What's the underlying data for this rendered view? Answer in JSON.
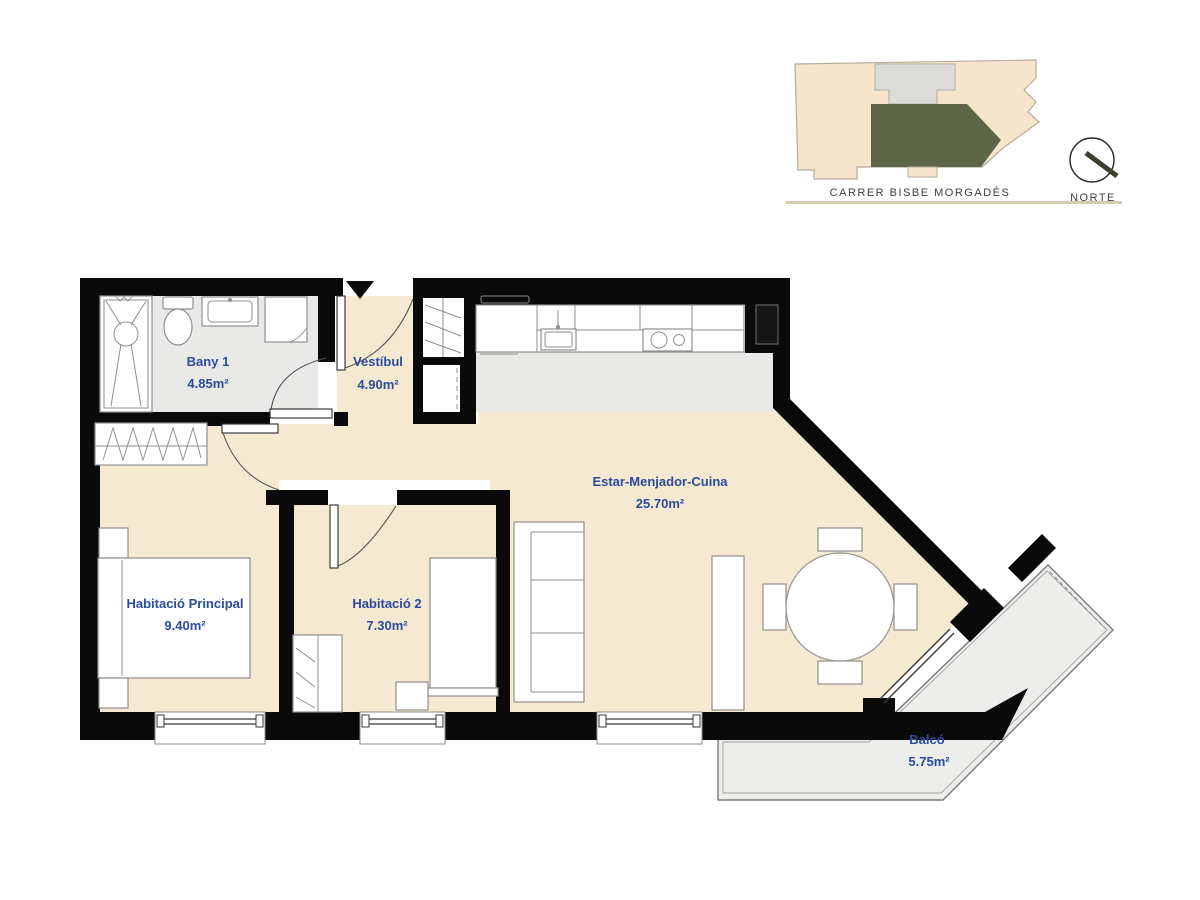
{
  "key_map": {
    "street_label": "CARRER BISBE MORGADÉS",
    "north_label": "NORTE",
    "colors": {
      "building": "#f5e5cb",
      "highlight_unit": "#5d6549",
      "stair_core": "#dcdcda",
      "outline": "#b3ac9e",
      "baseline": "#d8ccb0"
    }
  },
  "floor_plan": {
    "colors": {
      "wall": "#0a0a0a",
      "warm_floor": "#f6e9d2",
      "cool_floor": "#e9e9e7",
      "balcony_floor": "#ededeb",
      "label_text": "#2b4b9d",
      "furniture_line": "#8f8f8f"
    },
    "rooms": [
      {
        "id": "bany-1",
        "name": "Bany 1",
        "area": "4.85m²"
      },
      {
        "id": "vestibul",
        "name": "Vestíbul",
        "area": "4.90m²"
      },
      {
        "id": "estar-menjador-cuina",
        "name": "Estar-Menjador-Cuina",
        "area": "25.70m²"
      },
      {
        "id": "habitacio-principal",
        "name": "Habitació Principal",
        "area": "9.40m²"
      },
      {
        "id": "habitacio-2",
        "name": "Habitació 2",
        "area": "7.30m²"
      },
      {
        "id": "balco",
        "name": "Balcó",
        "area": "5.75m²"
      }
    ]
  }
}
